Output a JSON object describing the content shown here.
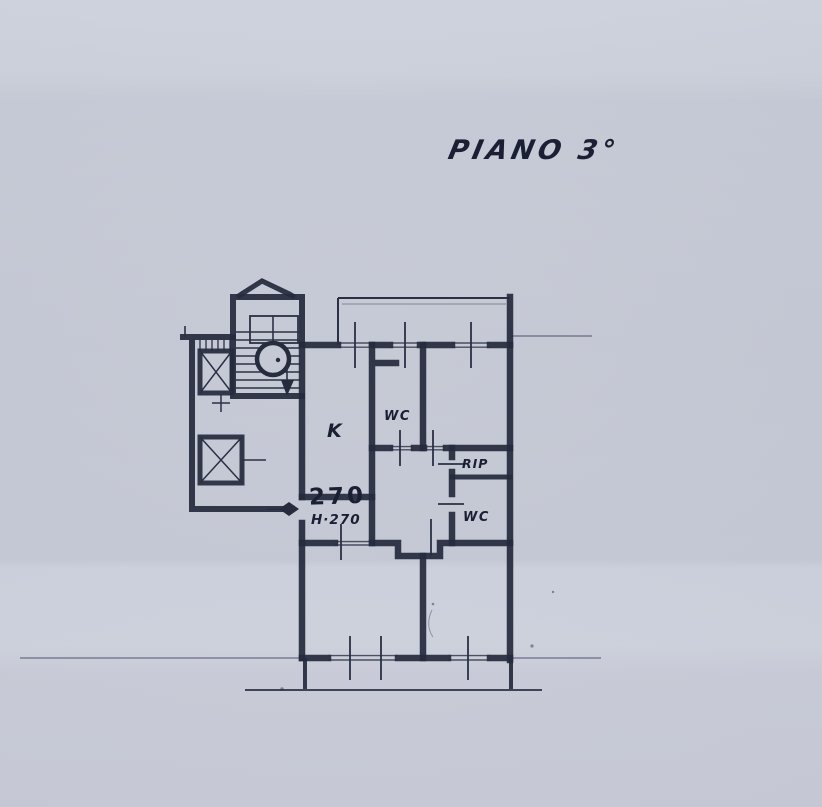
{
  "palette": {
    "paper": "#c5c9d5",
    "ink": "#262b3d",
    "faint_line": "#4d5470"
  },
  "title": {
    "text": "PIANO 3°"
  },
  "floorplan": {
    "rooms": {
      "kitchen": {
        "label": "K"
      },
      "wc_upper": {
        "label": "WC"
      },
      "storage": {
        "label": "RIP"
      },
      "wc_lower": {
        "label": "WC"
      }
    },
    "entrance": {
      "dimension": "270",
      "height_note": "H·270"
    }
  }
}
